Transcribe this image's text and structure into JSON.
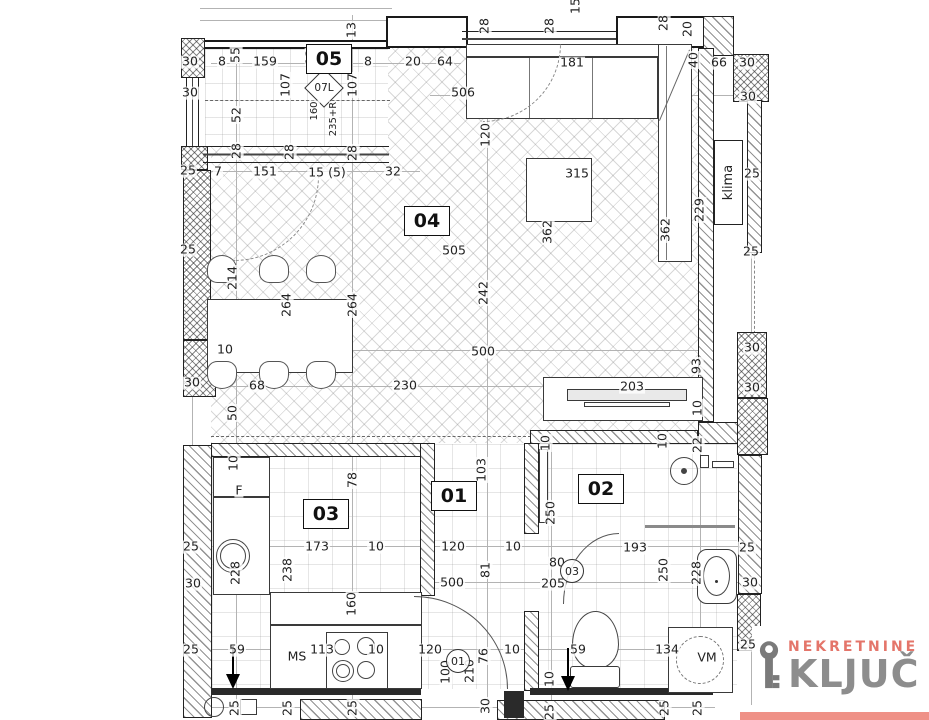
{
  "special": {
    "diamond": "07L",
    "klima": "klima"
  },
  "logo": {
    "top": "NEKRETNINE",
    "main": "KLJUČ",
    "top_color": "#e4756a",
    "main_color": "#8d8d8d",
    "bar_color": "#ef9187"
  },
  "rooms": [
    {
      "id": "05",
      "x": 329,
      "y": 59
    },
    {
      "id": "04",
      "x": 427,
      "y": 221
    },
    {
      "id": "03",
      "x": 326,
      "y": 514
    },
    {
      "id": "01",
      "x": 454,
      "y": 496
    },
    {
      "id": "02",
      "x": 601,
      "y": 489
    }
  ],
  "circled": [
    {
      "t": "01",
      "x": 458,
      "y": 661
    },
    {
      "t": "03",
      "x": 572,
      "y": 571
    }
  ],
  "labels": [
    {
      "t": "15",
      "x": 576,
      "y": 6,
      "r": 1
    },
    {
      "t": "28",
      "x": 485,
      "y": 26,
      "r": 1
    },
    {
      "t": "28",
      "x": 550,
      "y": 26,
      "r": 1
    },
    {
      "t": "28",
      "x": 664,
      "y": 23,
      "r": 1
    },
    {
      "t": "20",
      "x": 688,
      "y": 29,
      "r": 1
    },
    {
      "t": "13",
      "x": 352,
      "y": 30,
      "r": 1
    },
    {
      "t": "30",
      "x": 190,
      "y": 62
    },
    {
      "t": "8",
      "x": 222,
      "y": 62
    },
    {
      "t": "55",
      "x": 236,
      "y": 55,
      "r": 1
    },
    {
      "t": "159",
      "x": 265,
      "y": 62
    },
    {
      "t": "13",
      "x": 311,
      "y": 57,
      "r": 1
    },
    {
      "t": "8",
      "x": 368,
      "y": 62
    },
    {
      "t": "20",
      "x": 413,
      "y": 62
    },
    {
      "t": "64",
      "x": 445,
      "y": 62
    },
    {
      "t": "181",
      "x": 572,
      "y": 63
    },
    {
      "t": "40",
      "x": 694,
      "y": 60,
      "r": 1
    },
    {
      "t": "66",
      "x": 719,
      "y": 63
    },
    {
      "t": "30",
      "x": 747,
      "y": 63
    },
    {
      "t": "30",
      "x": 190,
      "y": 93
    },
    {
      "t": "506",
      "x": 463,
      "y": 93
    },
    {
      "t": "30",
      "x": 748,
      "y": 97
    },
    {
      "t": "107",
      "x": 286,
      "y": 85,
      "r": 1
    },
    {
      "t": "107",
      "x": 353,
      "y": 85,
      "r": 1
    },
    {
      "t": "160",
      "x": 315,
      "y": 111,
      "r": 1,
      "s": 1
    },
    {
      "t": "235+R",
      "x": 334,
      "y": 119,
      "r": 1,
      "s": 1
    },
    {
      "t": "52",
      "x": 237,
      "y": 115,
      "r": 1
    },
    {
      "t": "120",
      "x": 486,
      "y": 135,
      "r": 1
    },
    {
      "t": "229",
      "x": 700,
      "y": 210,
      "r": 1
    },
    {
      "t": "25",
      "x": 752,
      "y": 174
    },
    {
      "t": "28",
      "x": 237,
      "y": 151,
      "r": 1
    },
    {
      "t": "28",
      "x": 290,
      "y": 152,
      "r": 1
    },
    {
      "t": "28",
      "x": 353,
      "y": 153,
      "r": 1
    },
    {
      "t": "25",
      "x": 188,
      "y": 171
    },
    {
      "t": "7",
      "x": 218,
      "y": 172
    },
    {
      "t": "151",
      "x": 265,
      "y": 172
    },
    {
      "t": "15 (5)",
      "x": 327,
      "y": 173
    },
    {
      "t": "32",
      "x": 393,
      "y": 172
    },
    {
      "t": "315",
      "x": 577,
      "y": 174
    },
    {
      "t": "362",
      "x": 548,
      "y": 232,
      "r": 1
    },
    {
      "t": "362",
      "x": 666,
      "y": 230,
      "r": 1
    },
    {
      "t": "505",
      "x": 454,
      "y": 251
    },
    {
      "t": "25",
      "x": 188,
      "y": 250
    },
    {
      "t": "25",
      "x": 751,
      "y": 252
    },
    {
      "t": "214",
      "x": 233,
      "y": 278,
      "r": 1
    },
    {
      "t": "264",
      "x": 287,
      "y": 305,
      "r": 1
    },
    {
      "t": "264",
      "x": 353,
      "y": 305,
      "r": 1
    },
    {
      "t": "242",
      "x": 484,
      "y": 293,
      "r": 1
    },
    {
      "t": "10",
      "x": 225,
      "y": 350
    },
    {
      "t": "500",
      "x": 483,
      "y": 352
    },
    {
      "t": "30",
      "x": 752,
      "y": 348
    },
    {
      "t": "68",
      "x": 257,
      "y": 386
    },
    {
      "t": "230",
      "x": 405,
      "y": 386
    },
    {
      "t": "203",
      "x": 632,
      "y": 387
    },
    {
      "t": "93",
      "x": 697,
      "y": 366,
      "r": 1
    },
    {
      "t": "30",
      "x": 752,
      "y": 388
    },
    {
      "t": "30",
      "x": 192,
      "y": 383
    },
    {
      "t": "50",
      "x": 233,
      "y": 413,
      "r": 1
    },
    {
      "t": "10",
      "x": 698,
      "y": 408,
      "r": 1
    },
    {
      "t": "10",
      "x": 546,
      "y": 443,
      "r": 1
    },
    {
      "t": "10",
      "x": 663,
      "y": 441,
      "r": 1
    },
    {
      "t": "22",
      "x": 698,
      "y": 445,
      "r": 1
    },
    {
      "t": "10",
      "x": 234,
      "y": 463,
      "r": 1
    },
    {
      "t": "103",
      "x": 482,
      "y": 470,
      "r": 1
    },
    {
      "t": "78",
      "x": 353,
      "y": 480,
      "r": 1
    },
    {
      "t": "F",
      "x": 239,
      "y": 491
    },
    {
      "t": "250",
      "x": 551,
      "y": 513,
      "r": 1
    },
    {
      "t": "25",
      "x": 191,
      "y": 547
    },
    {
      "t": "173",
      "x": 317,
      "y": 547
    },
    {
      "t": "10",
      "x": 376,
      "y": 547
    },
    {
      "t": "120",
      "x": 453,
      "y": 547
    },
    {
      "t": "10",
      "x": 513,
      "y": 547
    },
    {
      "t": "193",
      "x": 635,
      "y": 548
    },
    {
      "t": "25",
      "x": 747,
      "y": 548
    },
    {
      "t": "80",
      "x": 557,
      "y": 563
    },
    {
      "t": "228",
      "x": 236,
      "y": 573,
      "r": 1
    },
    {
      "t": "238",
      "x": 288,
      "y": 570,
      "r": 1
    },
    {
      "t": "81",
      "x": 486,
      "y": 570,
      "r": 1
    },
    {
      "t": "250",
      "x": 664,
      "y": 570,
      "r": 1
    },
    {
      "t": "228",
      "x": 697,
      "y": 573,
      "r": 1
    },
    {
      "t": "500",
      "x": 452,
      "y": 583
    },
    {
      "t": "205",
      "x": 553,
      "y": 584
    },
    {
      "t": "30",
      "x": 193,
      "y": 584
    },
    {
      "t": "30",
      "x": 750,
      "y": 583
    },
    {
      "t": "160",
      "x": 352,
      "y": 604,
      "r": 1
    },
    {
      "t": "25",
      "x": 191,
      "y": 650
    },
    {
      "t": "59",
      "x": 237,
      "y": 650
    },
    {
      "t": "MS",
      "x": 297,
      "y": 657
    },
    {
      "t": "113",
      "x": 322,
      "y": 650
    },
    {
      "t": "10",
      "x": 376,
      "y": 650
    },
    {
      "t": "120",
      "x": 430,
      "y": 650
    },
    {
      "t": "10",
      "x": 512,
      "y": 650
    },
    {
      "t": "59",
      "x": 578,
      "y": 650
    },
    {
      "t": "134",
      "x": 667,
      "y": 650
    },
    {
      "t": "VM",
      "x": 707,
      "y": 658
    },
    {
      "t": "25",
      "x": 748,
      "y": 645
    },
    {
      "t": "100",
      "x": 446,
      "y": 672,
      "r": 1
    },
    {
      "t": "210",
      "x": 470,
      "y": 671,
      "r": 1
    },
    {
      "t": "76",
      "x": 484,
      "y": 656,
      "r": 1
    },
    {
      "t": "10",
      "x": 550,
      "y": 679,
      "r": 1
    },
    {
      "t": "30",
      "x": 486,
      "y": 706,
      "r": 1
    },
    {
      "t": "25",
      "x": 235,
      "y": 708,
      "r": 1
    },
    {
      "t": "25",
      "x": 288,
      "y": 708,
      "r": 1
    },
    {
      "t": "25",
      "x": 353,
      "y": 708,
      "r": 1
    },
    {
      "t": "25",
      "x": 550,
      "y": 712,
      "r": 1
    },
    {
      "t": "25",
      "x": 665,
      "y": 708,
      "r": 1
    },
    {
      "t": "25",
      "x": 698,
      "y": 708,
      "r": 1
    }
  ]
}
